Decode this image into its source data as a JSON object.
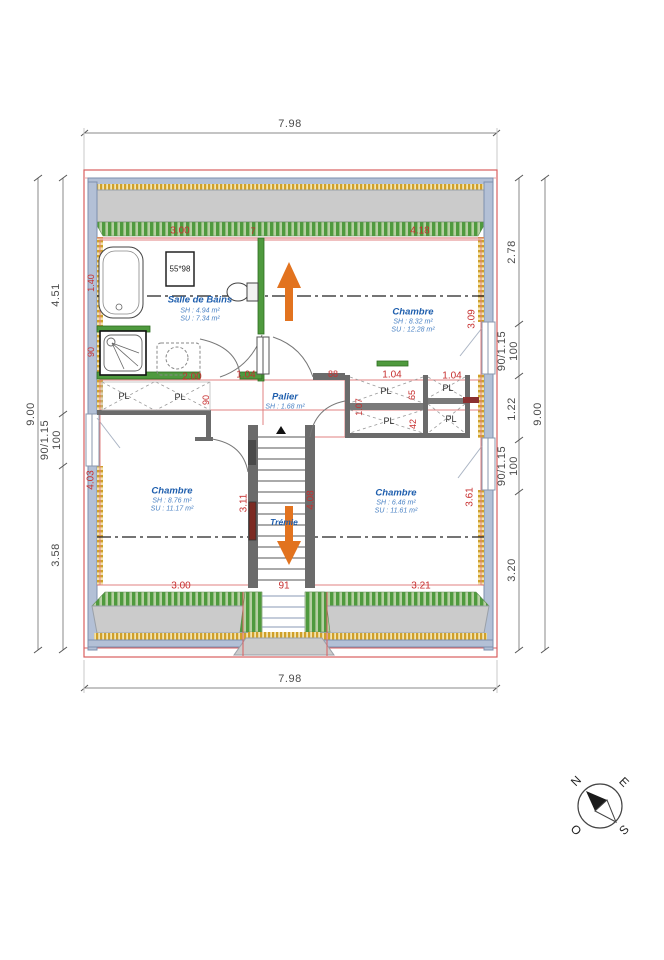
{
  "plan": {
    "scale_dims": {
      "top": "7.98",
      "bottom": "7.98",
      "left": {
        "total": "9.00",
        "seg1": "4.51",
        "win": "90/1.15",
        "win_h": "100",
        "seg2": "3.58"
      },
      "right": {
        "total": "9.00",
        "seg1": "2.78",
        "win1": "90/1.15",
        "win1_h": "100",
        "seg2": "1.22",
        "win2": "90/1.15",
        "win2_h": "100",
        "seg3": "3.20"
      }
    },
    "red_dims": {
      "bath_w": "3.00",
      "wall_t": "7",
      "chambre_tr_w": "4.18",
      "tub_l": "1.40",
      "shower_l": "90",
      "chambre_bl_h": "4.03",
      "closet_l_w": "2.00",
      "bath_door": "1.04",
      "door_w": "90",
      "wall_seg": "88",
      "closet_r1_w": "1.04",
      "closet_r2_w": "1.04",
      "closet_d1": "65",
      "closet_d2": "42",
      "closet_d3": "1.07",
      "chambre_tr_h": "3.09",
      "stair_l": "3.11",
      "stair_r": "4.08",
      "chambre_br_h": "3.61",
      "chambre_bl_w": "3.00",
      "stair_w": "91",
      "chambre_br_w": "3.21"
    },
    "rooms": {
      "bath": {
        "name": "Salle de Bains",
        "sh": "SH : 4.94 m²",
        "su": "SU : 7.34 m²"
      },
      "chambre_tr": {
        "name": "Chambre",
        "sh": "SH : 8.32 m²",
        "su": "SU : 12.28 m²"
      },
      "palier": {
        "name": "Palier",
        "sh": "SH : 1.68 m²"
      },
      "chambre_bl": {
        "name": "Chambre",
        "sh": "SH : 8.76 m²",
        "su": "SU : 11.17 m²"
      },
      "chambre_br": {
        "name": "Chambre",
        "sh": "SH : 6.46 m²",
        "su": "SU : 11.61 m²"
      },
      "tremie": {
        "name": "Trémie"
      }
    },
    "labels": {
      "closet": "PL",
      "window_note": "55*98"
    },
    "compass": {
      "n": "N",
      "e": "E",
      "s": "S",
      "o": "O"
    },
    "colors": {
      "dim_red": "#c72f2f",
      "room_blue": "#1f5fae",
      "wall_green": "#4f9a3e",
      "arrow_orange": "#e2731f",
      "frame_red": "#d95f5f",
      "wall_blue": "#b3c0d6",
      "insulation_yellow": "#cfa02a"
    }
  }
}
